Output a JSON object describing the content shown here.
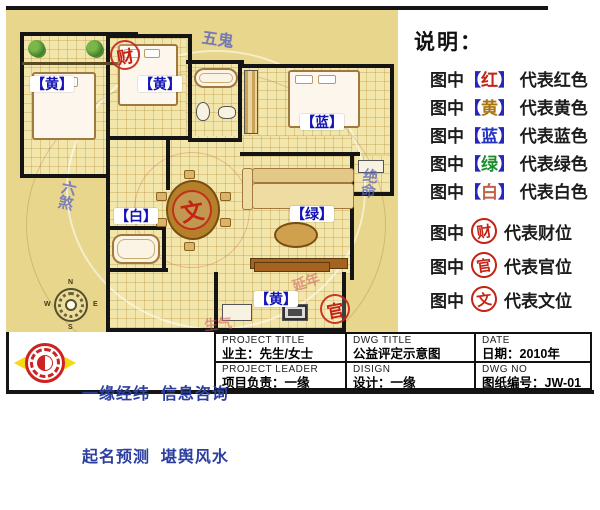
{
  "plan": {
    "room_labels": [
      {
        "id": "bedroom-left",
        "text": "【黄】"
      },
      {
        "id": "bedroom-mid",
        "text": "【黄】"
      },
      {
        "id": "bedroom-master",
        "text": "【蓝】"
      },
      {
        "id": "hallway",
        "text": "【白】"
      },
      {
        "id": "living-room",
        "text": "【绿】"
      },
      {
        "id": "kitchen",
        "text": "【黄】"
      }
    ],
    "stamps": [
      {
        "id": "wealth",
        "char": "财"
      },
      {
        "id": "literary",
        "char": "文"
      },
      {
        "id": "official",
        "char": "官"
      }
    ],
    "direction_labels": [
      {
        "text": "五鬼"
      },
      {
        "text": "六煞"
      },
      {
        "text": "绝命"
      },
      {
        "text": "延年"
      },
      {
        "text": "生气"
      }
    ],
    "compass": {
      "north": "N",
      "south": "S",
      "east": "E",
      "west": "W"
    }
  },
  "legend": {
    "title": "说明：",
    "color_rows": [
      {
        "prefix": "图中",
        "open": "【",
        "char": "红",
        "close": "】",
        "suffix": "代表红色",
        "char_color": "#c42218"
      },
      {
        "prefix": "图中",
        "open": "【",
        "char": "黄",
        "close": "】",
        "suffix": "代表黄色",
        "char_color": "#a8750e"
      },
      {
        "prefix": "图中",
        "open": "【",
        "char": "蓝",
        "close": "】",
        "suffix": "代表蓝色",
        "char_color": "#2433c4"
      },
      {
        "prefix": "图中",
        "open": "【",
        "char": "绿",
        "close": "】",
        "suffix": "代表绿色",
        "char_color": "#1f8c2e"
      },
      {
        "prefix": "图中",
        "open": "【",
        "char": "白",
        "close": "】",
        "suffix": "代表白色",
        "char_color": "#c2604a"
      }
    ],
    "position_rows": [
      {
        "prefix": "图中",
        "char": "财",
        "suffix": "代表财位"
      },
      {
        "prefix": "图中",
        "char": "官",
        "suffix": "代表官位"
      },
      {
        "prefix": "图中",
        "char": "文",
        "suffix": "代表文位"
      }
    ]
  },
  "title_block": {
    "cells": [
      {
        "label": "PROJECT TITLE",
        "value": "业主：先生/女士"
      },
      {
        "label": "DWG TITLE",
        "value": "公益评定示意图"
      },
      {
        "label": "DATE",
        "value": "日期：2010年"
      },
      {
        "label": "PROJECT LEADER",
        "value": "项目负责：一缘"
      },
      {
        "label": "DISIGN",
        "value": "设计：一缘"
      },
      {
        "label": "DWG NO",
        "value": "图纸编号：JW-01"
      }
    ]
  },
  "logo": {
    "line1": "一缘经纬  信息咨询",
    "line2": "起名预测  堪舆风水"
  },
  "colors": {
    "plan_bg": "#e8d68c",
    "room_floor": "#f3e6ab",
    "wall": "#141414",
    "room_label_blue": "#1414b4",
    "stamp_red": "#c42315",
    "legend_bracket_blue": "#2626bb",
    "logo_text_blue": "#2c3fa0",
    "frame_black": "#151515"
  }
}
